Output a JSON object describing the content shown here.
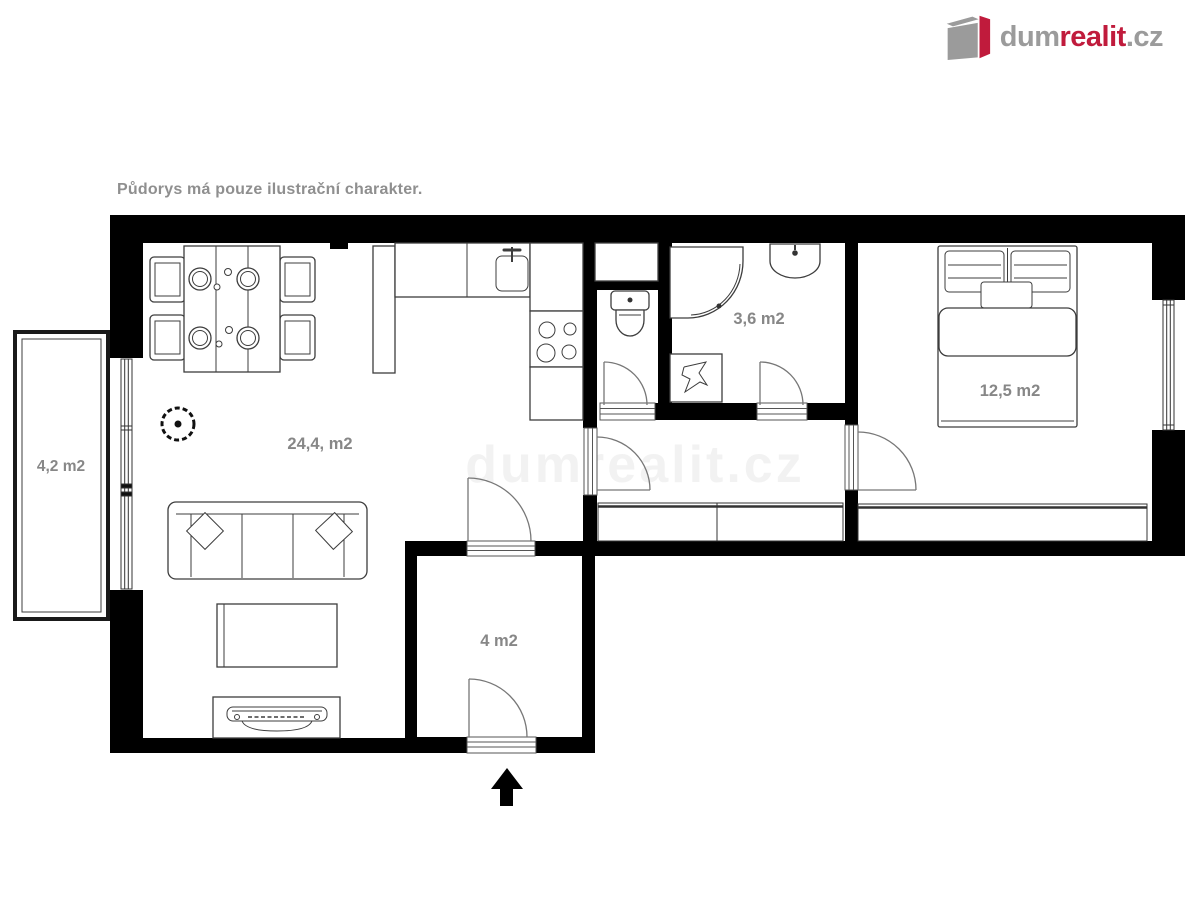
{
  "disclaimer": "Půdorys má pouze ilustrační charakter.",
  "watermark": "dumrealit.cz",
  "logo": {
    "part_gray1": "dum",
    "part_red": "realit",
    "part_gray2": ".cz"
  },
  "rooms": {
    "living_room": {
      "area_label": "24,4, m2"
    },
    "hall": {
      "area_label": "4 m2"
    },
    "bathroom": {
      "area_label": "3,6 m2"
    },
    "bedroom": {
      "area_label": "12,5 m2"
    },
    "balcony": {
      "area_label": "4,2 m2"
    }
  },
  "colors": {
    "wall": "#000000",
    "furniture_line": "#3d3d3d",
    "label_text": "#878787",
    "logo_gray": "#9b9b9b",
    "logo_red": "#c01b3c",
    "background": "#ffffff"
  }
}
